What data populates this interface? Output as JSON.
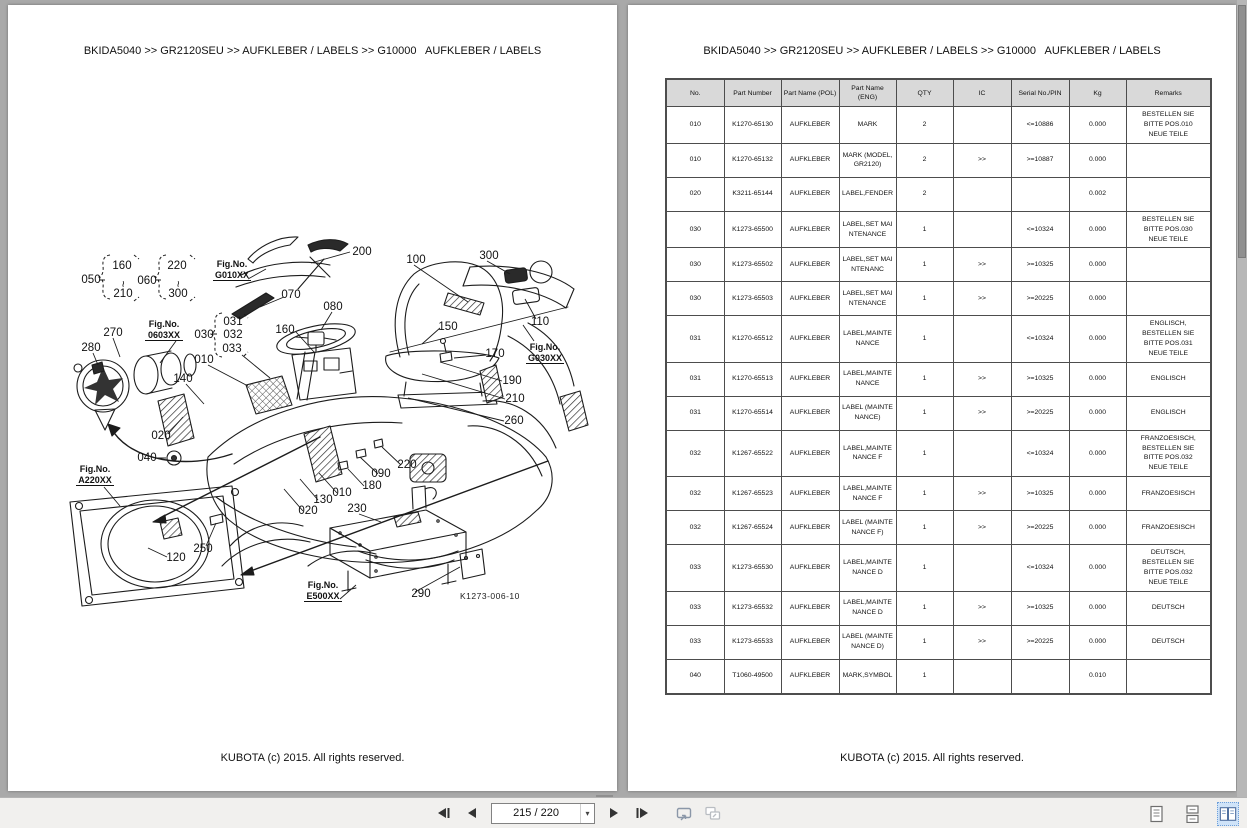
{
  "left_page": {
    "breadcrumb": "BKIDA5040 >> GR2120SEU >> AUFKLEBER / LABELS >> G10000   AUFKLEBER / LABELS",
    "footer": "KUBOTA (c) 2015. All rights reserved.",
    "diagram": {
      "drawing_number": "K1273-006-10",
      "callouts": [
        {
          "t": "050",
          "x": 83,
          "y": 278
        },
        {
          "t": "160",
          "x": 114,
          "y": 264
        },
        {
          "t": "~",
          "x": 111,
          "y": 279
        },
        {
          "t": "210",
          "x": 115,
          "y": 292
        },
        {
          "t": "060",
          "x": 139,
          "y": 279
        },
        {
          "t": "220",
          "x": 169,
          "y": 264
        },
        {
          "t": "~",
          "x": 166,
          "y": 279
        },
        {
          "t": "300",
          "x": 170,
          "y": 292
        },
        {
          "t": "200",
          "x": 354,
          "y": 250
        },
        {
          "t": "100",
          "x": 408,
          "y": 258
        },
        {
          "t": "300",
          "x": 481,
          "y": 254
        },
        {
          "t": "070",
          "x": 283,
          "y": 293
        },
        {
          "t": "080",
          "x": 325,
          "y": 305
        },
        {
          "t": "110",
          "x": 532,
          "y": 320
        },
        {
          "t": "150",
          "x": 440,
          "y": 325
        },
        {
          "t": "170",
          "x": 487,
          "y": 352
        },
        {
          "t": "190",
          "x": 504,
          "y": 379
        },
        {
          "t": "210",
          "x": 507,
          "y": 397
        },
        {
          "t": "260",
          "x": 506,
          "y": 419
        },
        {
          "t": "270",
          "x": 105,
          "y": 331
        },
        {
          "t": "280",
          "x": 83,
          "y": 346
        },
        {
          "t": "030",
          "x": 196,
          "y": 333
        },
        {
          "t": "031",
          "x": 225,
          "y": 320
        },
        {
          "t": "032",
          "x": 225,
          "y": 333
        },
        {
          "t": "033",
          "x": 224,
          "y": 347
        },
        {
          "t": "010",
          "x": 196,
          "y": 358
        },
        {
          "t": "160",
          "x": 277,
          "y": 328
        },
        {
          "t": "140",
          "x": 175,
          "y": 377
        },
        {
          "t": "020",
          "x": 153,
          "y": 434
        },
        {
          "t": "040",
          "x": 139,
          "y": 456
        },
        {
          "t": "090",
          "x": 373,
          "y": 472
        },
        {
          "t": "220",
          "x": 399,
          "y": 463
        },
        {
          "t": "180",
          "x": 364,
          "y": 484
        },
        {
          "t": "010",
          "x": 334,
          "y": 491
        },
        {
          "t": "130",
          "x": 315,
          "y": 498
        },
        {
          "t": "020",
          "x": 300,
          "y": 509
        },
        {
          "t": "230",
          "x": 349,
          "y": 507
        },
        {
          "t": "250",
          "x": 195,
          "y": 547
        },
        {
          "t": "120",
          "x": 168,
          "y": 556
        },
        {
          "t": "290",
          "x": 413,
          "y": 592
        }
      ],
      "fig_refs": [
        {
          "label": "Fig.No.",
          "value": "G010XX",
          "x": 224,
          "y": 262
        },
        {
          "label": "Fig.No.",
          "value": "0603XX",
          "x": 156,
          "y": 322
        },
        {
          "label": "Fig.No.",
          "value": "G030XX",
          "x": 537,
          "y": 345
        },
        {
          "label": "Fig.No.",
          "value": "A220XX",
          "x": 87,
          "y": 467
        },
        {
          "label": "Fig.No.",
          "value": "E500XX",
          "x": 315,
          "y": 583
        }
      ]
    }
  },
  "right_page": {
    "breadcrumb": "BKIDA5040 >> GR2120SEU >> AUFKLEBER / LABELS >> G10000   AUFKLEBER / LABELS",
    "footer": "KUBOTA (c) 2015. All rights reserved.",
    "table": {
      "headers": [
        "No.",
        "Part Number",
        "Part Name (POL)",
        "Part Name (ENG)",
        "QTY",
        "IC",
        "Serial No./PIN",
        "Kg",
        "Remarks"
      ],
      "rows": [
        [
          "010",
          "K1270-65130",
          "AUFKLEBER",
          "MARK",
          "2",
          "",
          "<=10886",
          "0.000",
          "BESTELLEN SIE BITTE POS.010 NEUE TEILE"
        ],
        [
          "010",
          "K1270-65132",
          "AUFKLEBER",
          "MARK (MODEL,GR2120)",
          "2",
          ">>",
          ">=10887",
          "0.000",
          ""
        ],
        [
          "020",
          "K3211-65144",
          "AUFKLEBER",
          "LABEL,FENDER",
          "2",
          "",
          "",
          "0.002",
          ""
        ],
        [
          "030",
          "K1273-65500",
          "AUFKLEBER",
          "LABEL,SET MAINTENANCE",
          "1",
          "",
          "<=10324",
          "0.000",
          "BESTELLEN SIE BITTE POS.030 NEUE TEILE"
        ],
        [
          "030",
          "K1273-65502",
          "AUFKLEBER",
          "LABEL,SET MAINTENANC",
          "1",
          ">>",
          ">=10325",
          "0.000",
          ""
        ],
        [
          "030",
          "K1273-65503",
          "AUFKLEBER",
          "LABEL,SET MAINTENANCE",
          "1",
          ">>",
          ">=20225",
          "0.000",
          ""
        ],
        [
          "031",
          "K1270-65512",
          "AUFKLEBER",
          "LABEL,MAINTENANCE",
          "1",
          "",
          "<=10324",
          "0.000",
          "ENGLISCH, BESTELLEN SIE BITTE POS.031 NEUE TEILE"
        ],
        [
          "031",
          "K1270-65513",
          "AUFKLEBER",
          "LABEL,MAINTENANCE",
          "1",
          ">>",
          ">=10325",
          "0.000",
          "ENGLISCH"
        ],
        [
          "031",
          "K1270-65514",
          "AUFKLEBER",
          "LABEL (MAINTENANCE)",
          "1",
          ">>",
          ">=20225",
          "0.000",
          "ENGLISCH"
        ],
        [
          "032",
          "K1267-65522",
          "AUFKLEBER",
          "LABEL,MAINTENANCE F",
          "1",
          "",
          "<=10324",
          "0.000",
          "FRANZOESISCH, BESTELLEN SIE BITTE POS.032 NEUE TEILE"
        ],
        [
          "032",
          "K1267-65523",
          "AUFKLEBER",
          "LABEL,MAINTENANCE F",
          "1",
          ">>",
          ">=10325",
          "0.000",
          "FRANZOESISCH"
        ],
        [
          "032",
          "K1267-65524",
          "AUFKLEBER",
          "LABEL (MAINTENANCE F)",
          "1",
          ">>",
          ">=20225",
          "0.000",
          "FRANZOESISCH"
        ],
        [
          "033",
          "K1273-65530",
          "AUFKLEBER",
          "LABEL,MAINTENANCE D",
          "1",
          "",
          "<=10324",
          "0.000",
          "DEUTSCH, BESTELLEN SIE BITTE POS.032 NEUE TEILE"
        ],
        [
          "033",
          "K1273-65532",
          "AUFKLEBER",
          "LABEL,MAINTENANCE D",
          "1",
          ">>",
          ">=10325",
          "0.000",
          "DEUTSCH"
        ],
        [
          "033",
          "K1273-65533",
          "AUFKLEBER",
          "LABEL (MAINTENANCE D)",
          "1",
          ">>",
          ">=20225",
          "0.000",
          "DEUTSCH"
        ],
        [
          "040",
          "T1060-49500",
          "AUFKLEBER",
          "MARK,SYMBOL",
          "1",
          "",
          "",
          "0.010",
          ""
        ]
      ]
    }
  },
  "toolbar": {
    "page_indicator": "215 / 220",
    "icons": [
      "first-page",
      "previous-page",
      "page-select",
      "next-page",
      "last-page",
      "popout-page",
      "popout-copy",
      "single-page-view",
      "continuous-view",
      "two-page-view"
    ],
    "active_view": "two-page-view"
  }
}
